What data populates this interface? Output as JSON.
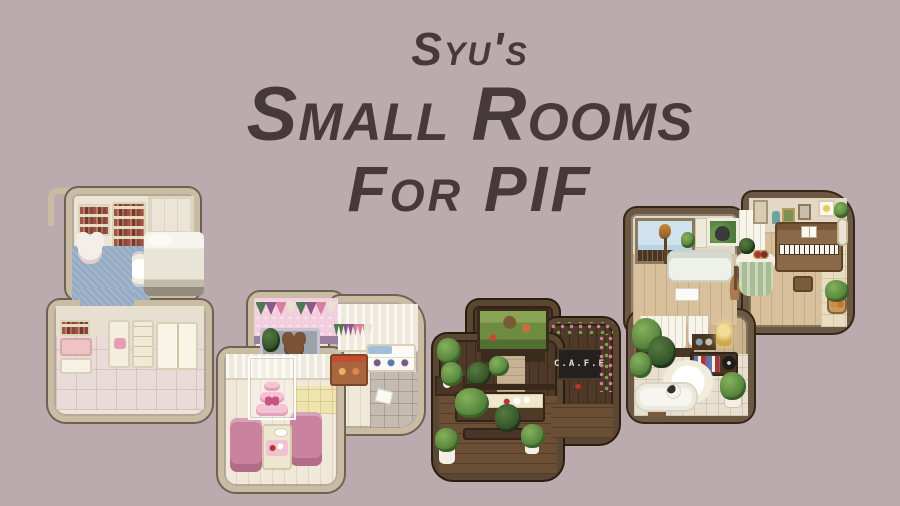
{
  "canvas": {
    "background": "#bcabae"
  },
  "title": {
    "line1": "Syu's",
    "line2": "Small Rooms",
    "line3": "For PIF",
    "color": "#46393b"
  },
  "rooms": {
    "bedroom": {
      "label": "pixel-art bedroom preview with bookshelves, bed, blue carpet and wardrobe"
    },
    "bakery": {
      "label": "pixel-art bakery preview with bunting, teddy counter, pink cake and armchairs"
    },
    "cafe": {
      "label": "pixel-art plant cafe preview with aquarium and chalkboard sign",
      "sign": "C.A.F.E"
    },
    "music": {
      "label": "pixel-art living room preview with balcony, sofa, round table and piano"
    },
    "bath": {
      "label": "pixel-art bathroom nook preview with plants, bookshelf and bathtub"
    }
  },
  "palette": {
    "background": "#bcabae",
    "title_text": "#46393b",
    "light_room_border": "#c9bca2",
    "dark_room_border": "#5a4733",
    "mid_room_border": "#6b5845",
    "cream_wall": "#ece5d5",
    "pink_wall": "#f3cede",
    "carpet_blue": "#95aac3",
    "armchair_pink": "#c9839e",
    "cake_pink": "#f5c3d3",
    "plant_green": "#5d8a42",
    "light_wood_floor": "#d8c09c",
    "dark_wood_floor": "#6b4f35"
  }
}
